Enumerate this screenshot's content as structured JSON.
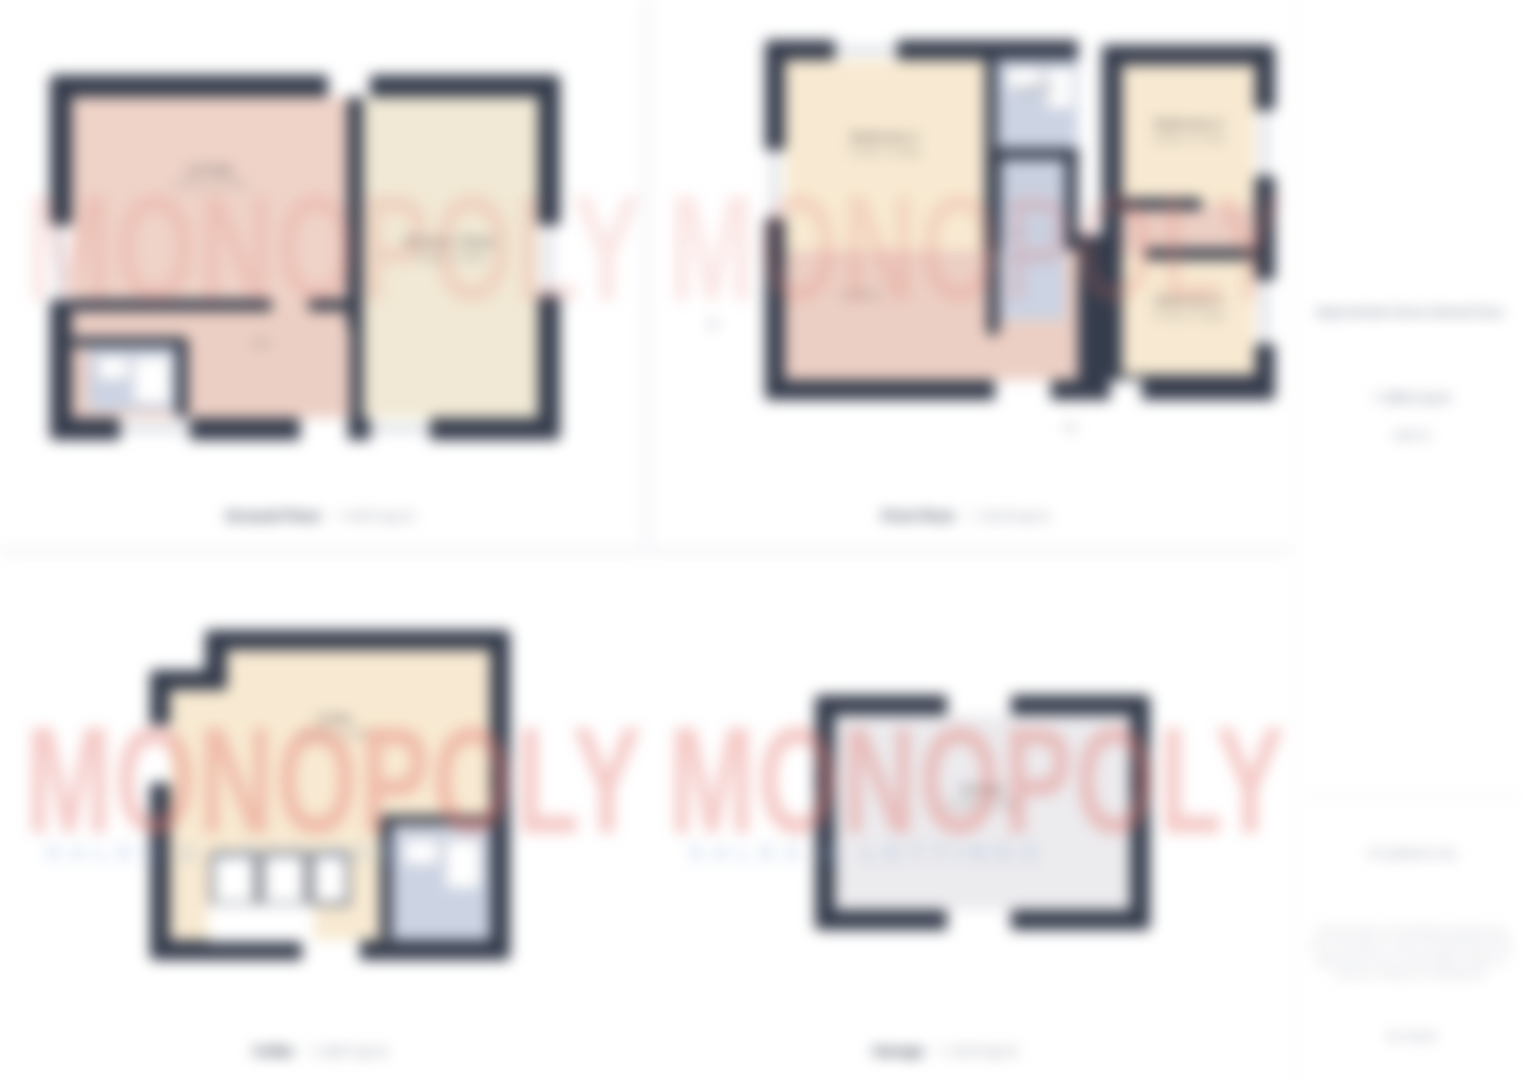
{
  "watermark": {
    "text": "MONOPOLY",
    "tagline": "SALES & LETTINGS"
  },
  "plans": {
    "ground": {
      "caption_bold": "Ground Floor",
      "caption_area": "= 44.9 sq m",
      "rooms": {
        "lounge": {
          "name": "Lounge",
          "dims": "4.57m x 3.73m"
        },
        "kitchen": {
          "name": "Kitchen / Diner",
          "dims": "3.68m x 3.05m"
        },
        "hall": {
          "name": "Hall",
          "dims": ""
        }
      }
    },
    "first": {
      "caption_bold": "First Floor",
      "caption_area": "= 41.8 sq m",
      "rooms": {
        "bedroom1": {
          "name": "Bedroom 1",
          "dims": "3.73m x 3.35m"
        },
        "bathroom": {
          "name": "Bathroom",
          "dims": ""
        },
        "bedroom2": {
          "name": "Bedroom 2",
          "dims": "3.05m x 2.74m"
        },
        "bedroom3": {
          "name": "Bedroom 3",
          "dims": "2.74m x 2.44m"
        },
        "landing": {
          "name": "Landing",
          "dims": ""
        },
        "stairs_note": "up",
        "entrance_note": "IN"
      }
    },
    "cellar": {
      "caption_bold": "Cellar",
      "caption_area": "= 18.6 sq m",
      "rooms": {
        "cellar": {
          "name": "Cellar",
          "dims": "4.27m x 3.96m"
        },
        "store": {
          "name": "Store",
          "dims": ""
        }
      }
    },
    "garage": {
      "caption_bold": "Garage",
      "caption_area": "= 14.9 sq m",
      "rooms": {
        "garage": {
          "name": "Garage",
          "dims": "5.18m x 2.90m"
        }
      }
    }
  },
  "sidebar": {
    "title": "Approximate Gross Internal Area",
    "value": "= 120.2 sq m",
    "value_note": "(approx)",
    "guidance": "For guidance only",
    "disclaimer": "This floor plan is for illustrative purposes only and is not drawn to scale. All measurements are approximate and no responsibility is taken for any error, omission or misstatement.",
    "reference": "Ref: 000000"
  }
}
